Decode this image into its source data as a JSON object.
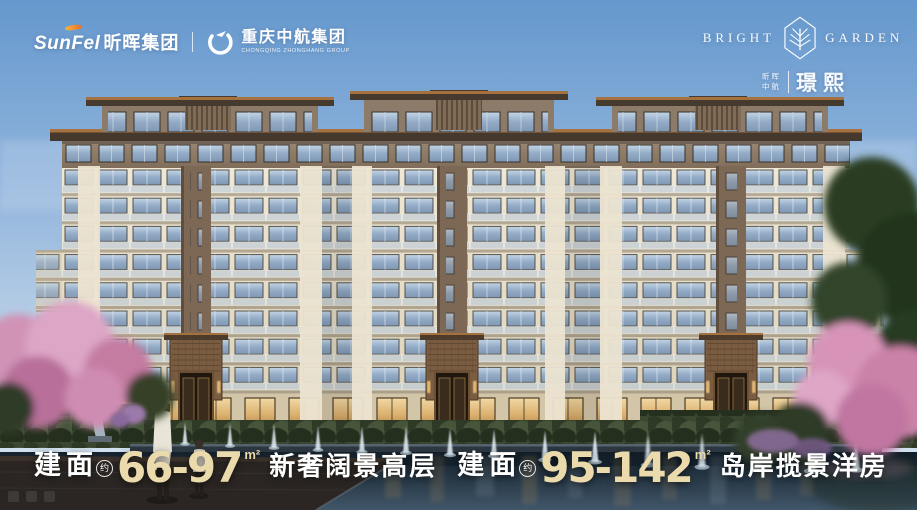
{
  "header": {
    "sunfel": {
      "en": "SunFel",
      "cn": "昕晖集团"
    },
    "separator": "|",
    "zhonghang": {
      "cn": "重庆中航集团",
      "en": "CHONGQING ZHONGHANG GROUP"
    }
  },
  "badge": {
    "en_left": "BRIGHT",
    "en_right": "GARDEN",
    "cn_small_1": "昕晖",
    "cn_small_2": "中航",
    "project": "璟熙"
  },
  "tagline": {
    "segments": [
      {
        "label": "建面",
        "approx": "约",
        "range": "66-97",
        "unit": "m²",
        "desc": "新奢阔景高层"
      },
      {
        "label": "建面",
        "approx": "约",
        "range": "95-142",
        "unit": "m²",
        "desc": "岛岸揽景洋房"
      }
    ]
  },
  "colors": {
    "accent_cream": "#EADAAC",
    "text_white": "#FFFFFF",
    "sky_top": "#6B9CD2",
    "facade_cream": "#E7DFCC",
    "facade_brown": "#8C7A68",
    "roof_copper": "#A4713F",
    "blossom_pink": "#D998BA",
    "pool_dark": "#22303B"
  }
}
